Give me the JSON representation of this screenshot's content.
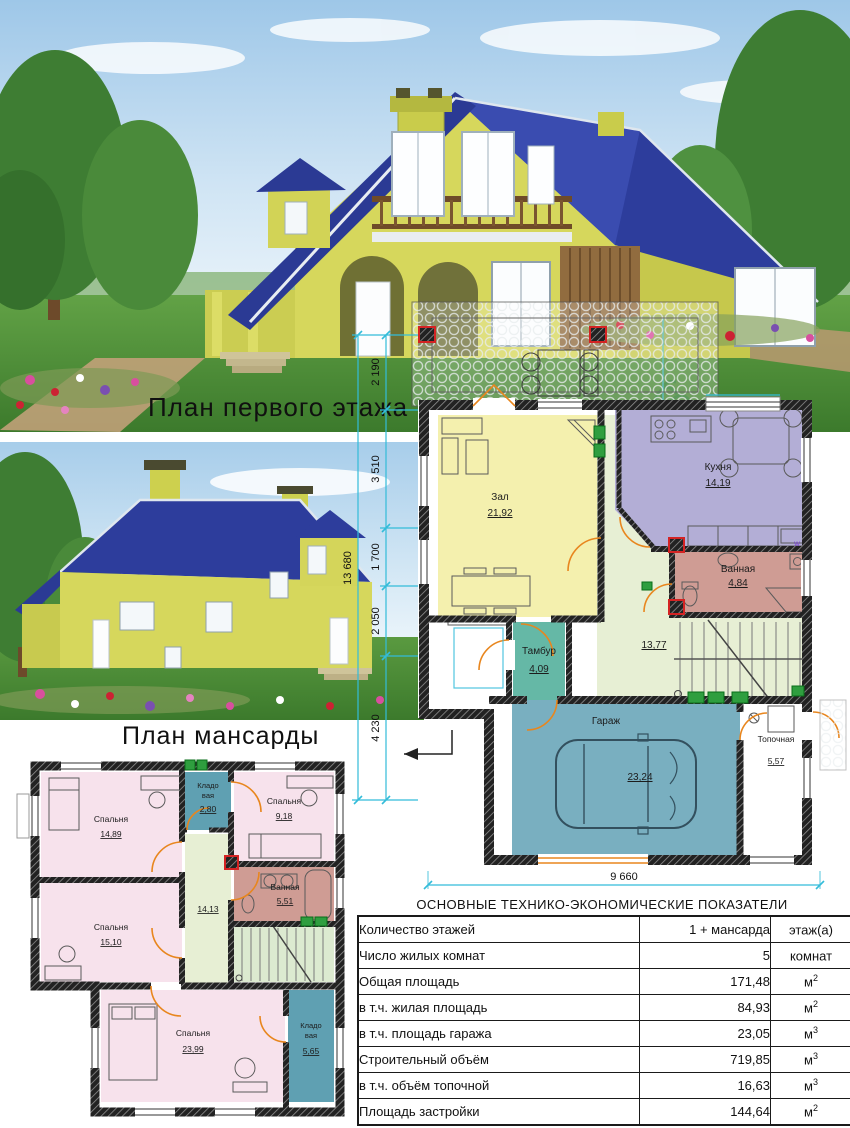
{
  "colors": {
    "dim": "#33bcd9",
    "door": "#e8861e",
    "living": "#f4f0ae",
    "kitchen": "#b3aed6",
    "bath": "#cf9c94",
    "vestibule": "#65b8a6",
    "corridor": "#e7efd4",
    "garage": "#79afc0",
    "bedroom": "#f7e2ec",
    "storage": "#5fa0b2",
    "stairs_bg": "#dcead0",
    "plant": "#2f9e3f",
    "red_post": "#d42323",
    "roof": "#2d3d9c",
    "house_wall": "#d6d75c"
  },
  "captions": {
    "first_floor": "План первого этажа",
    "attic": "План мансарды"
  },
  "dimensions": {
    "overall": "13 680",
    "seg1": "2 190",
    "seg2": "3 510",
    "seg3": "1 700",
    "seg4": "2 050",
    "seg5": "4 230",
    "width": "9 660"
  },
  "first_floor": {
    "living": {
      "name": "Зал",
      "area": "21,92"
    },
    "kitchen": {
      "name": "Кухня",
      "area": "14,19"
    },
    "bath": {
      "name": "Ванная",
      "area": "4,84"
    },
    "washer": "w",
    "vestibule": {
      "name": "Тамбур",
      "area": "4,09"
    },
    "corridor": {
      "area": "13,77"
    },
    "garage": {
      "name": "Гараж",
      "area": "23,24"
    },
    "boiler": {
      "name": "Топочная",
      "area": "5,57"
    }
  },
  "attic": {
    "bedroom1": {
      "name": "Спальня",
      "area": "14,89"
    },
    "storage1": {
      "l1": "Кладо",
      "l2": "вая",
      "area": "2,80"
    },
    "bedroom2": {
      "name": "Спальня",
      "area": "9,18"
    },
    "bath": {
      "name": "Ванная",
      "area": "5,51"
    },
    "corridor": {
      "area": "14,13"
    },
    "bedroom3": {
      "name": "Спальня",
      "area": "15,10"
    },
    "bedroom4": {
      "name": "Спальня",
      "area": "23,99"
    },
    "storage2": {
      "l1": "Кладо",
      "l2": "вая",
      "area": "5,65"
    }
  },
  "table": {
    "title": "ОСНОВНЫЕ ТЕХНИКО-ЭКОНОМИЧЕСКИЕ ПОКАЗАТЕЛИ",
    "rows": [
      {
        "label": "Количество этажей",
        "value": "1 + мансарда",
        "unit": "этаж(а)",
        "sup": ""
      },
      {
        "label": "Число жилых комнат",
        "value": "5",
        "unit": "комнат",
        "sup": ""
      },
      {
        "label": "Общая площадь",
        "value": "171,48",
        "unit": "м",
        "sup": "2"
      },
      {
        "label": "в т.ч. жилая площадь",
        "value": "84,93",
        "unit": "м",
        "sup": "2"
      },
      {
        "label": "в т.ч. площадь гаража",
        "value": "23,05",
        "unit": "м",
        "sup": "3"
      },
      {
        "label": "Строительный объём",
        "value": "719,85",
        "unit": "м",
        "sup": "3"
      },
      {
        "label": "в т.ч. объём топочной",
        "value": "16,63",
        "unit": "м",
        "sup": "3"
      },
      {
        "label": "Площадь застройки",
        "value": "144,64",
        "unit": "м",
        "sup": "2"
      }
    ]
  }
}
